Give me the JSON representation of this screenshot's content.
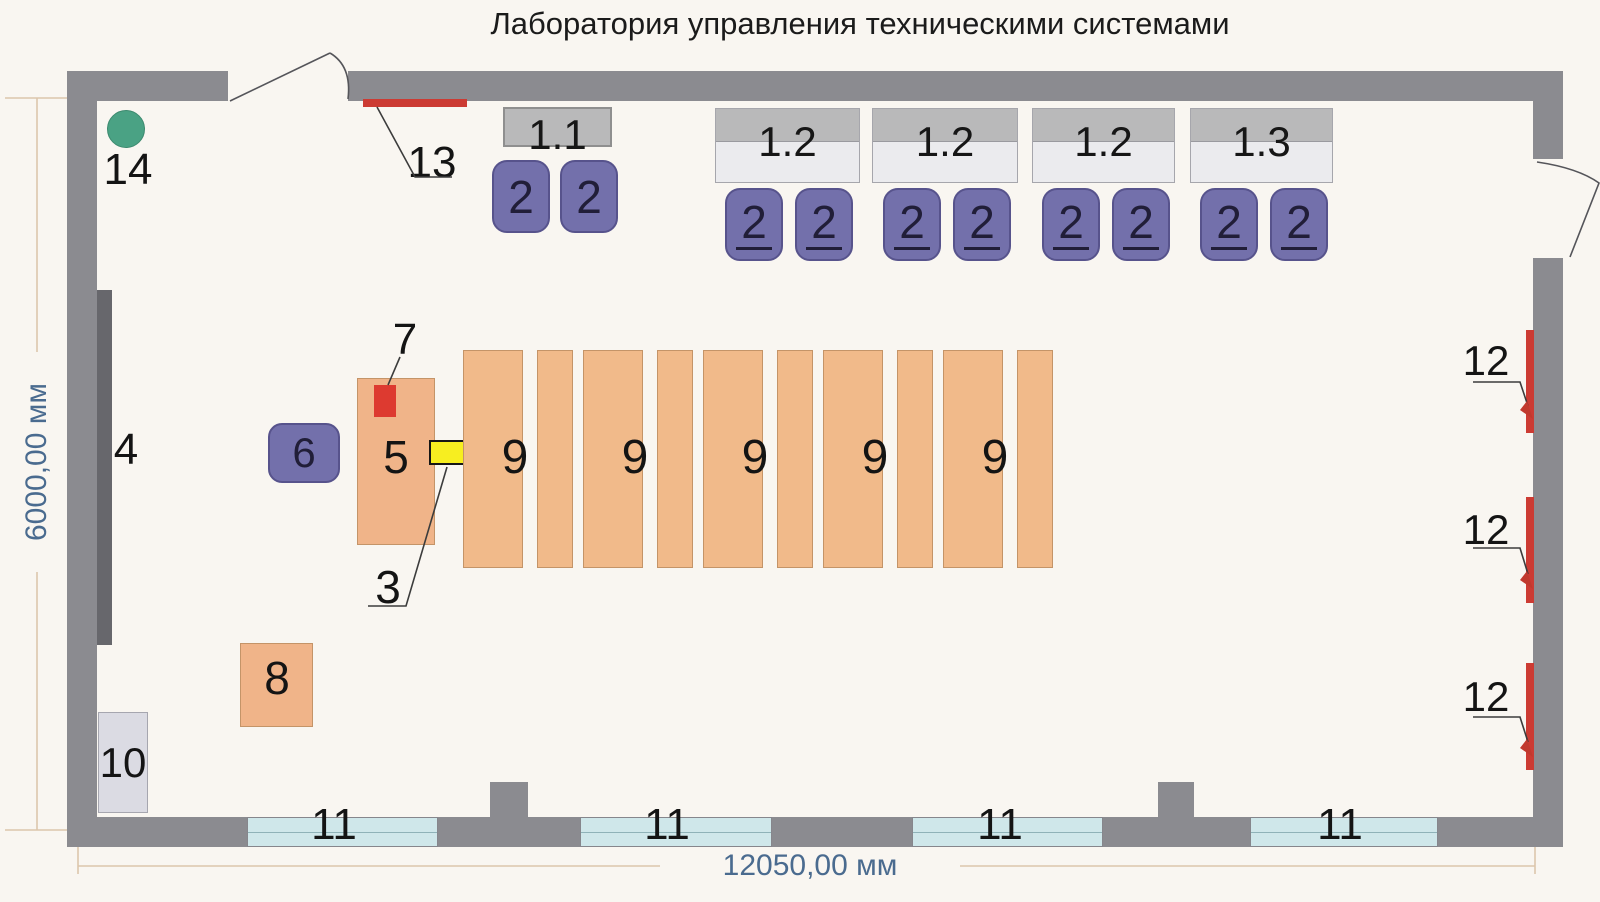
{
  "title": "Лаборатория управления техническими системами",
  "dimensions": {
    "width": "12050,00 мм",
    "height": "6000,00 мм"
  },
  "elements": {
    "green_circle": "14",
    "top_heater": "13",
    "wall_board": "4",
    "teacher_desk": "5",
    "teacher_chair": "6",
    "desk_device_red": "7",
    "desk_device_yellow": "3",
    "side_table": "8",
    "cabinet": "10"
  },
  "tables": [
    {
      "label": "1.1"
    },
    {
      "label": "1.2"
    },
    {
      "label": "1.2"
    },
    {
      "label": "1.2"
    },
    {
      "label": "1.3"
    }
  ],
  "chairs": [
    {
      "label": "2"
    },
    {
      "label": "2"
    },
    {
      "label": "2"
    },
    {
      "label": "2"
    },
    {
      "label": "2"
    },
    {
      "label": "2"
    },
    {
      "label": "2"
    },
    {
      "label": "2"
    },
    {
      "label": "2"
    },
    {
      "label": "2"
    }
  ],
  "benches": [
    {
      "label": "9"
    },
    {
      "label": "9"
    },
    {
      "label": "9"
    },
    {
      "label": "9"
    },
    {
      "label": "9"
    }
  ],
  "windows": [
    {
      "label": "11"
    },
    {
      "label": "11"
    },
    {
      "label": "11"
    },
    {
      "label": "11"
    }
  ],
  "radiators": [
    {
      "label": "12"
    },
    {
      "label": "12"
    },
    {
      "label": "12"
    }
  ],
  "colors": {
    "wall": "#8b8b90",
    "board": "#67676c",
    "chair_purple": "#7370ab",
    "bench_orange": "#f1ba8a",
    "table_gray_dark": "#b9b9ba",
    "table_gray_light": "#ebebee",
    "window_cyan": "#cfe7ea",
    "radiator_red": "#cc3b33",
    "device_red": "#dd3a30",
    "device_yellow": "#f7ee20",
    "circle_green": "#4aa284",
    "cabinet_gray": "#dbdbe3",
    "dimension_text": "#4a6b8f"
  }
}
